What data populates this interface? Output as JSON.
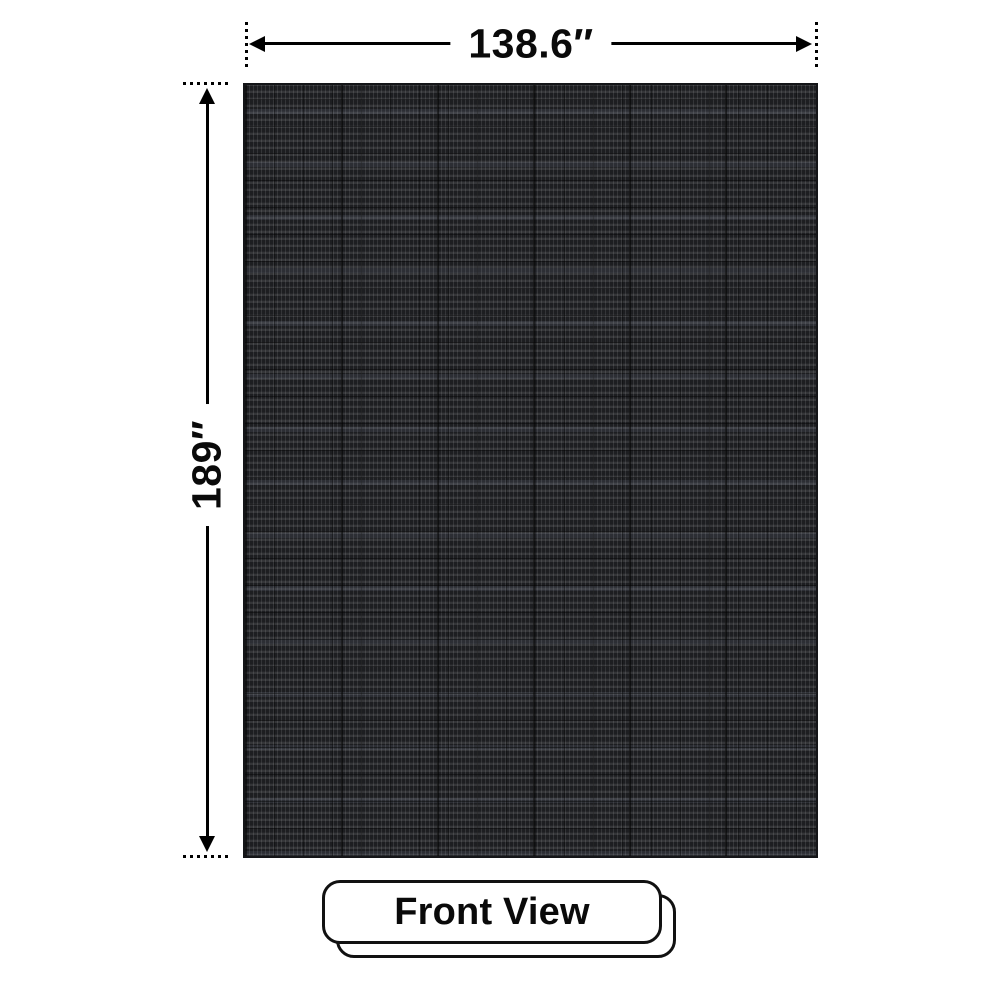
{
  "dimensions": {
    "width": "138.6″",
    "height": "189″"
  },
  "view": {
    "label": "Front View"
  },
  "panel": {
    "kind": "led-mesh-panel-front",
    "base_color": "#1d1e21"
  },
  "colors": {
    "background": "#ffffff",
    "dimension_line": "#000000",
    "card_border": "#111111",
    "text": "#0a0a0a"
  }
}
